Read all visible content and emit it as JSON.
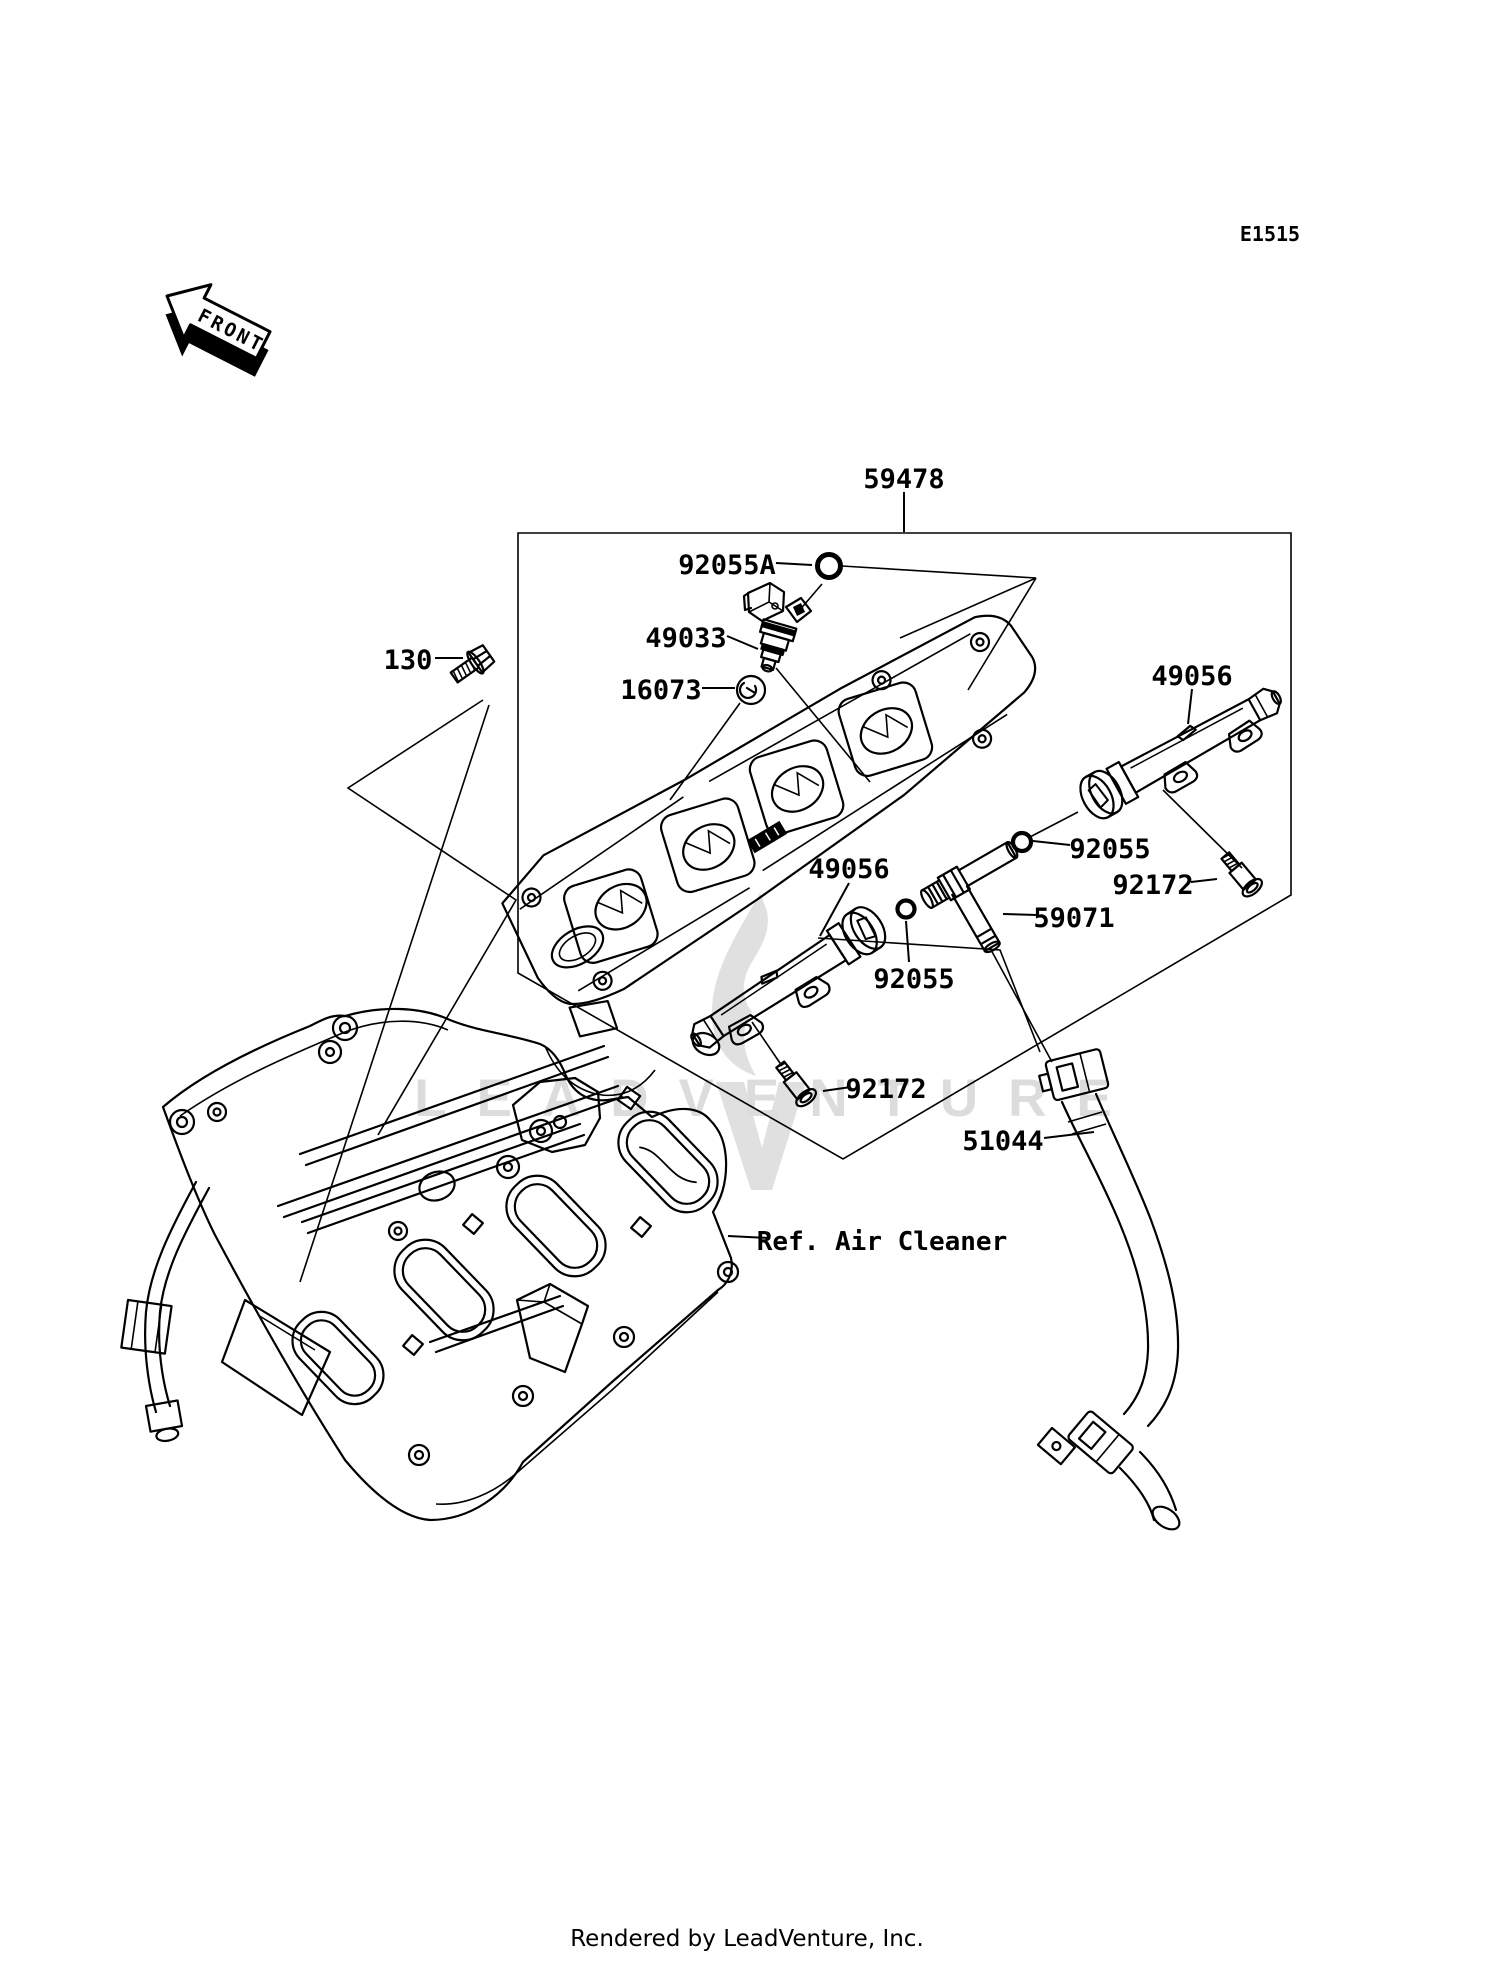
{
  "diagram": {
    "sheet_code": "E1515",
    "front_marker": "FRONT",
    "reference_note": "Ref. Air Cleaner",
    "watermark": {
      "text": "LEADVENTURE",
      "color": "#dcdcdc"
    },
    "footer": "Rendered by LeadVenture, Inc.",
    "ink_color": "#000000",
    "background": "#ffffff",
    "part_labels": [
      {
        "id": "group-box",
        "text": "59478"
      },
      {
        "id": "o-ring-upper",
        "text": "92055A"
      },
      {
        "id": "injector",
        "text": "49033"
      },
      {
        "id": "insulator-washer",
        "text": "16073"
      },
      {
        "id": "flange-bolt",
        "text": "130"
      },
      {
        "id": "fuel-rail-right",
        "text": "49056"
      },
      {
        "id": "o-ring-right",
        "text": "92055"
      },
      {
        "id": "screw-right",
        "text": "92172"
      },
      {
        "id": "tee-joint",
        "text": "59071"
      },
      {
        "id": "fuel-rail-left",
        "text": "49056"
      },
      {
        "id": "o-ring-left",
        "text": "92055"
      },
      {
        "id": "screw-left",
        "text": "92172"
      },
      {
        "id": "fuel-hose",
        "text": "51044"
      }
    ]
  }
}
